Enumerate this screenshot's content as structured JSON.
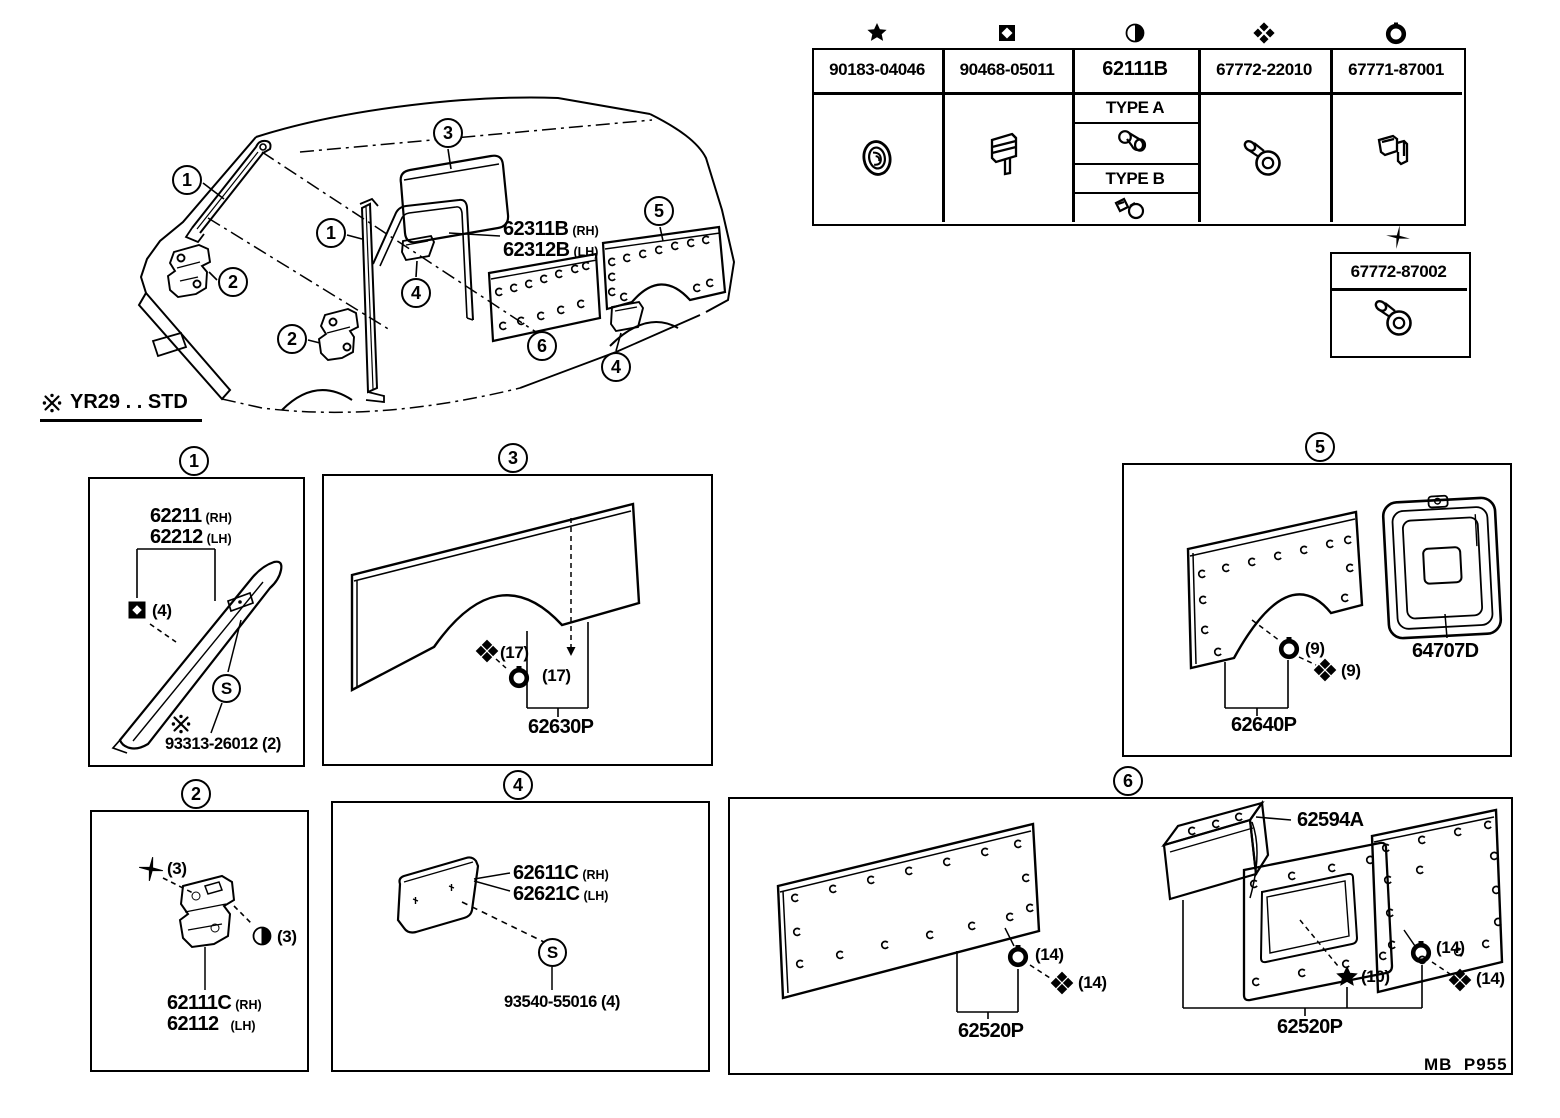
{
  "page": {
    "note_mark": "※",
    "note": "YR29 . . STD",
    "footer": "MB  P955"
  },
  "fastener_table": {
    "col1": {
      "symbol": "star",
      "part": "90183-04046"
    },
    "col2": {
      "symbol": "square-diamond",
      "part": "90468-05011"
    },
    "col3": {
      "symbol": "half-circle",
      "part": "62111B",
      "type_a": "TYPE A",
      "type_b": "TYPE B"
    },
    "col4": {
      "symbol": "quad-cross",
      "part": "67772-22010"
    },
    "col5": {
      "symbol": "ring",
      "part": "67771-87001"
    },
    "extra": {
      "symbol": "sparkle",
      "part": "67772-87002"
    }
  },
  "main": {
    "part_rh": "62311B",
    "side_rh": "(RH)",
    "part_lh": "62312B",
    "side_lh": "(LH)",
    "callout_1": "1",
    "callout_2": "2",
    "callout_3": "3",
    "callout_4": "4",
    "callout_5": "5",
    "callout_6": "6"
  },
  "box1": {
    "num": "1",
    "part_rh": "62211",
    "side_rh": "(RH)",
    "part_lh": "62212",
    "side_lh": "(LH)",
    "clip_qty": "(4)",
    "s": "S",
    "screw_ref": "93313-26012 (2)"
  },
  "box2": {
    "num": "2",
    "screw_qty": "(3)",
    "clip_qty": "(3)",
    "part_rh": "62111C",
    "side_rh": "(RH)",
    "part_lh": "62112",
    "side_lh": "(LH)"
  },
  "box3": {
    "num": "3",
    "screw_qty": "(17)",
    "ring_qty": "(17)",
    "part": "62630P"
  },
  "box4": {
    "num": "4",
    "part_rh": "62611C",
    "side_rh": "(RH)",
    "part_lh": "62621C",
    "side_lh": "(LH)",
    "s": "S",
    "screw_ref": "93540-55016 (4)"
  },
  "box5": {
    "num": "5",
    "ring_qty": "(9)",
    "screw_qty": "(9)",
    "part": "62640P",
    "part_b": "64707D"
  },
  "box6": {
    "num": "6",
    "part_top": "62594A",
    "ring_qty_l": "(14)",
    "screw_qty_l": "(14)",
    "part_l": "62520P",
    "star_qty": "(10)",
    "ring_qty_r": "(14)",
    "screw_qty_r": "(14)",
    "part_r": "62520P"
  }
}
